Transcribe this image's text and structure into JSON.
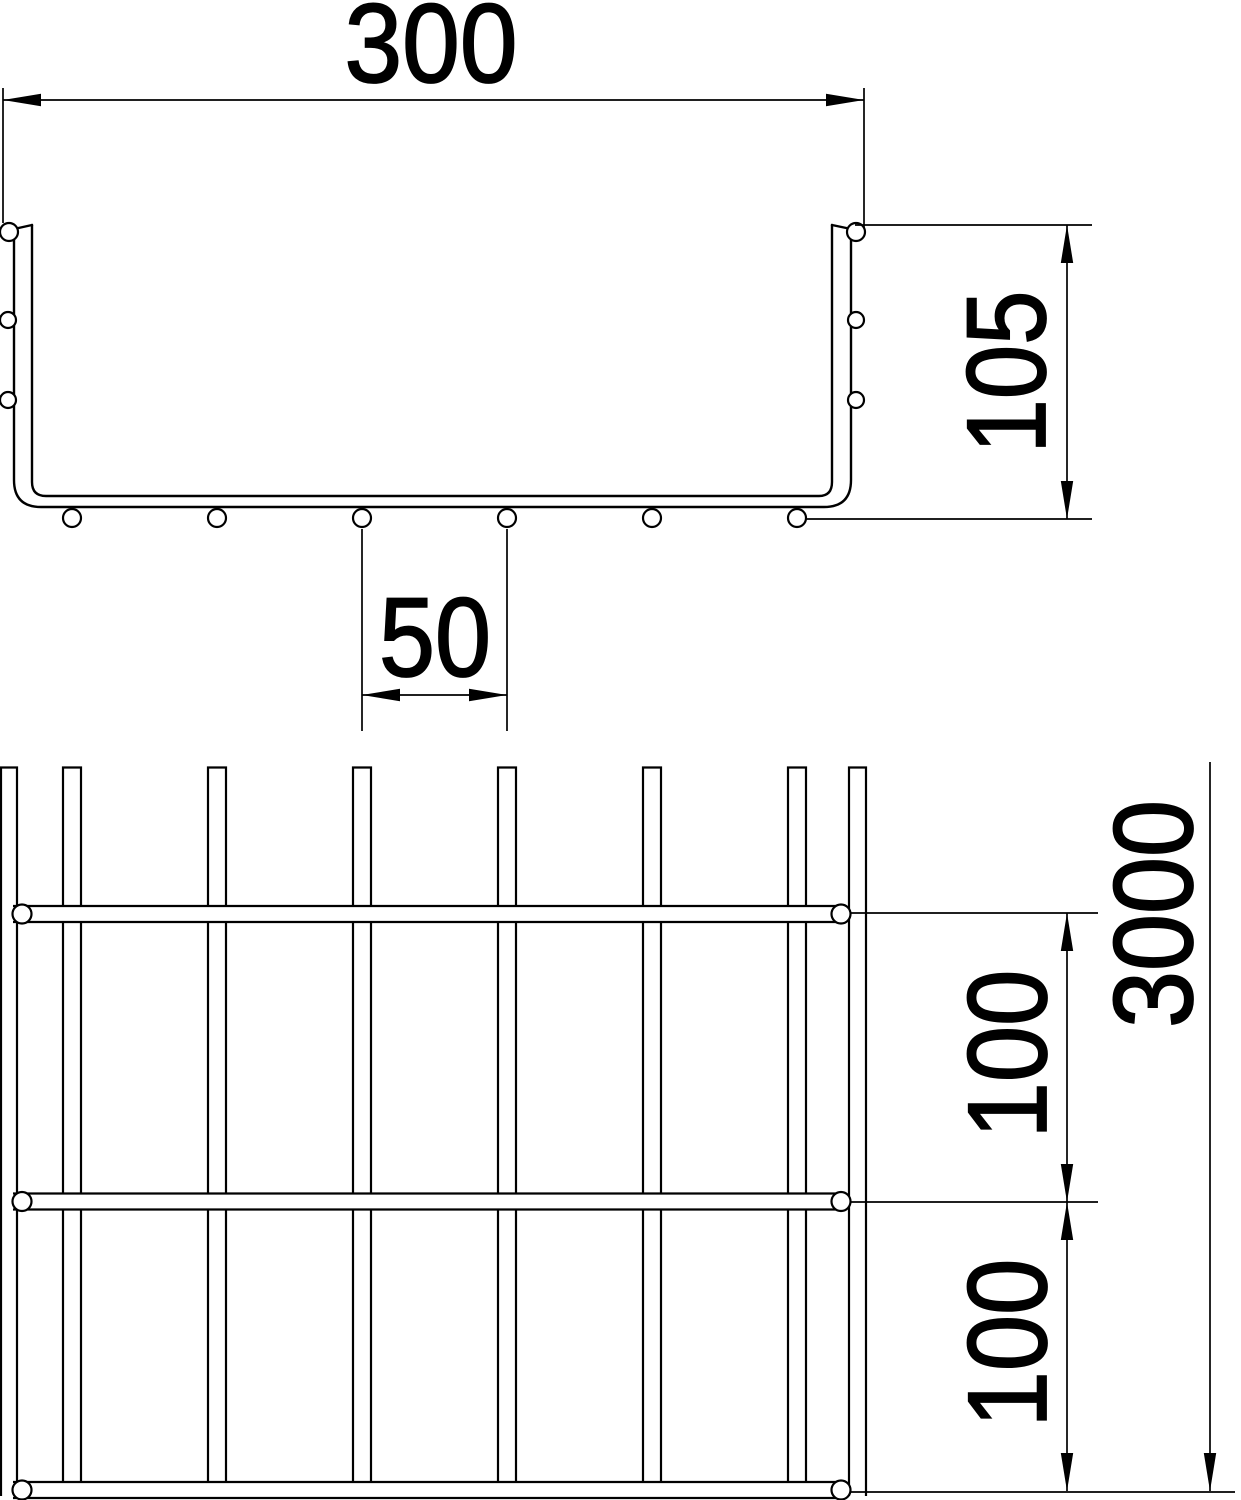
{
  "drawing": {
    "type": "technical-dimension-drawing",
    "subject": "wire-mesh-cable-tray",
    "colors": {
      "line": "#000000",
      "background": "#ffffff"
    },
    "cross_section": {
      "width": "300",
      "height": "105",
      "wire_spacing": "50"
    },
    "plan_view": {
      "rung_spacing_upper": "100",
      "rung_spacing_lower": "100",
      "length": "3000"
    }
  }
}
